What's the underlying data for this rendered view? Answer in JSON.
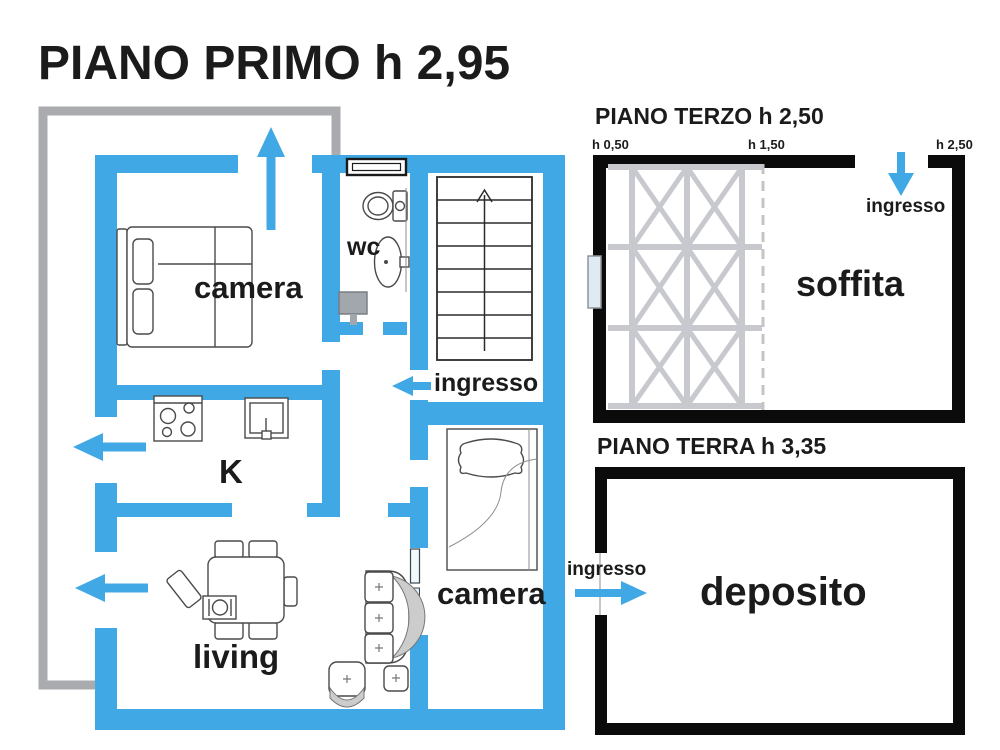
{
  "colors": {
    "wall_blue": "#40a9e5",
    "arrow_blue": "#40a9e5",
    "wall_black": "#0b0b0b",
    "balcony_gray": "#a9abae",
    "truss_gray": "#c7c9cf",
    "text": "#1b1b1b",
    "background": "#ffffff"
  },
  "primo": {
    "title": "PIANO PRIMO h 2,95",
    "labels": {
      "camera1": "camera",
      "wc": "wc",
      "ingresso": "ingresso",
      "kitchen": "K",
      "living": "living",
      "camera2": "camera"
    }
  },
  "terzo": {
    "title": "PIANO TERZO h 2,50",
    "heights": {
      "left": "h 0,50",
      "mid": "h 1,50",
      "right": "h 2,50"
    },
    "labels": {
      "ingresso": "ingresso",
      "soffita": "soffita"
    }
  },
  "terra": {
    "title": "PIANO TERRA h 3,35",
    "labels": {
      "ingresso": "ingresso",
      "deposito": "deposito"
    }
  }
}
